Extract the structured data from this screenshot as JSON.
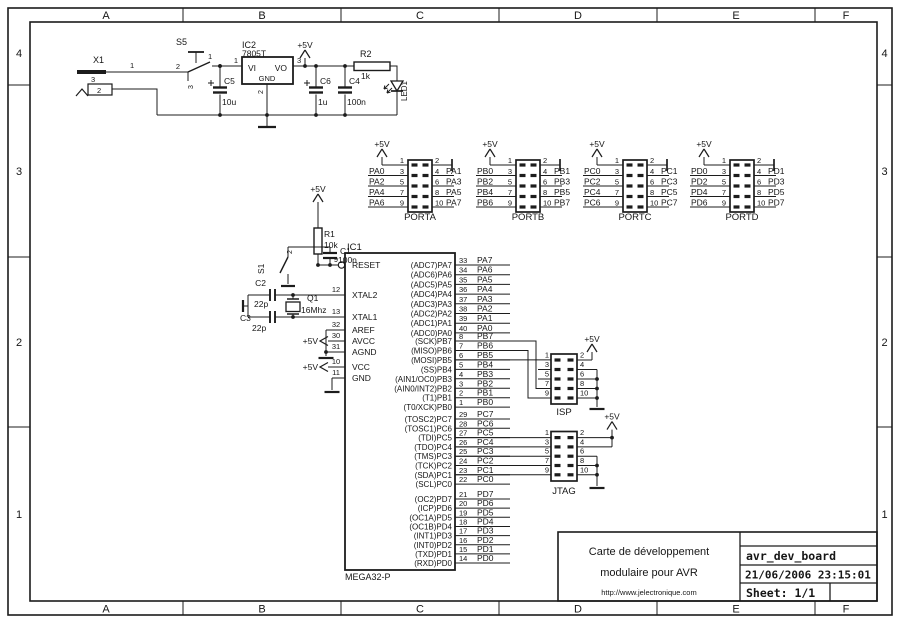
{
  "frame": {
    "columns": [
      "A",
      "B",
      "C",
      "D",
      "E",
      "F"
    ],
    "rows": [
      "4",
      "3",
      "2",
      "1"
    ]
  },
  "title_block": {
    "line1": "Carte de développement",
    "line2": "modulaire pour AVR",
    "url": "http://www.jelectronique.com",
    "doc": "avr_dev_board",
    "datetime": "21/06/2006 23:15:01",
    "sheet": "Sheet: 1/1"
  },
  "power": {
    "vcc": "+5V",
    "x1": {
      "ref": "X1",
      "pin1": "1",
      "pin2": "2",
      "pin3": "3"
    },
    "s5": {
      "ref": "S5",
      "pin1": "1",
      "pin2": "2",
      "pin3": "3"
    },
    "ic2": {
      "ref": "IC2",
      "value": "7805T",
      "vi": "VI",
      "vo": "VO",
      "gnd": "GND",
      "pin_in": "1",
      "pin_out": "3",
      "pin_gnd": "2"
    },
    "c5": {
      "ref": "C5",
      "value": "10u"
    },
    "c6": {
      "ref": "C6",
      "value": "1u"
    },
    "c4": {
      "ref": "C4",
      "value": "100n"
    },
    "r2": {
      "ref": "R2",
      "value": "1k"
    },
    "led": {
      "ref": "LED1"
    }
  },
  "reset": {
    "vcc": "+5V",
    "r1": {
      "ref": "R1",
      "value": "10k"
    },
    "c1": {
      "ref": "C1",
      "value": "100n"
    },
    "s1": {
      "ref": "S1",
      "pin_top": "2"
    }
  },
  "xtal": {
    "q1": {
      "ref": "Q1",
      "value": "16Mhz"
    },
    "c2": {
      "ref": "C2",
      "value": "22p"
    },
    "c3": {
      "ref": "C3",
      "value": "22p"
    }
  },
  "headers": [
    {
      "name": "PORTA",
      "vcc": "+5V",
      "left": [
        {
          "pin": "1",
          "net": ""
        },
        {
          "pin": "3",
          "net": "PA0"
        },
        {
          "pin": "5",
          "net": "PA2"
        },
        {
          "pin": "7",
          "net": "PA4"
        },
        {
          "pin": "9",
          "net": "PA6"
        }
      ],
      "right": [
        {
          "pin": "2",
          "net": ""
        },
        {
          "pin": "4",
          "net": "PA1"
        },
        {
          "pin": "6",
          "net": "PA3"
        },
        {
          "pin": "8",
          "net": "PA5"
        },
        {
          "pin": "10",
          "net": "PA7"
        }
      ]
    },
    {
      "name": "PORTB",
      "vcc": "+5V",
      "left": [
        {
          "pin": "1",
          "net": ""
        },
        {
          "pin": "3",
          "net": "PB0"
        },
        {
          "pin": "5",
          "net": "PB2"
        },
        {
          "pin": "7",
          "net": "PB4"
        },
        {
          "pin": "9",
          "net": "PB6"
        }
      ],
      "right": [
        {
          "pin": "2",
          "net": ""
        },
        {
          "pin": "4",
          "net": "PB1"
        },
        {
          "pin": "6",
          "net": "PB3"
        },
        {
          "pin": "8",
          "net": "PB5"
        },
        {
          "pin": "10",
          "net": "PB7"
        }
      ]
    },
    {
      "name": "PORTC",
      "vcc": "+5V",
      "left": [
        {
          "pin": "1",
          "net": ""
        },
        {
          "pin": "3",
          "net": "PC0"
        },
        {
          "pin": "5",
          "net": "PC2"
        },
        {
          "pin": "7",
          "net": "PC4"
        },
        {
          "pin": "9",
          "net": "PC6"
        }
      ],
      "right": [
        {
          "pin": "2",
          "net": ""
        },
        {
          "pin": "4",
          "net": "PC1"
        },
        {
          "pin": "6",
          "net": "PC3"
        },
        {
          "pin": "8",
          "net": "PC5"
        },
        {
          "pin": "10",
          "net": "PC7"
        }
      ]
    },
    {
      "name": "PORTD",
      "vcc": "+5V",
      "left": [
        {
          "pin": "1",
          "net": ""
        },
        {
          "pin": "3",
          "net": "PD0"
        },
        {
          "pin": "5",
          "net": "PD2"
        },
        {
          "pin": "7",
          "net": "PD4"
        },
        {
          "pin": "9",
          "net": "PD6"
        }
      ],
      "right": [
        {
          "pin": "2",
          "net": ""
        },
        {
          "pin": "4",
          "net": "PD1"
        },
        {
          "pin": "6",
          "net": "PD3"
        },
        {
          "pin": "8",
          "net": "PD5"
        },
        {
          "pin": "10",
          "net": "PD7"
        }
      ]
    }
  ],
  "mcu": {
    "ref": "IC1",
    "value": "MEGA32-P",
    "vcc": "+5V",
    "left_pins": [
      {
        "name": "RESET",
        "pin": "9"
      },
      {
        "name": "XTAL2",
        "pin": "12"
      },
      {
        "name": "XTAL1",
        "pin": "13"
      },
      {
        "name": "AREF",
        "pin": "32"
      },
      {
        "name": "AVCC",
        "pin": "30"
      },
      {
        "name": "AGND",
        "pin": "31"
      },
      {
        "name": "VCC",
        "pin": "10"
      },
      {
        "name": "GND",
        "pin": "11"
      }
    ],
    "pa": [
      {
        "name": "(ADC7)PA7",
        "pin": "33",
        "net": "PA7"
      },
      {
        "name": "(ADC6)PA6",
        "pin": "34",
        "net": "PA6"
      },
      {
        "name": "(ADC5)PA5",
        "pin": "35",
        "net": "PA5"
      },
      {
        "name": "(ADC4)PA4",
        "pin": "36",
        "net": "PA4"
      },
      {
        "name": "(ADC3)PA3",
        "pin": "37",
        "net": "PA3"
      },
      {
        "name": "(ADC2)PA2",
        "pin": "38",
        "net": "PA2"
      },
      {
        "name": "(ADC1)PA1",
        "pin": "39",
        "net": "PA1"
      },
      {
        "name": "(ADC0)PA0",
        "pin": "40",
        "net": "PA0"
      }
    ],
    "pb": [
      {
        "name": "(SCK)PB7",
        "pin": "8",
        "net": "PB7"
      },
      {
        "name": "(MISO)PB6",
        "pin": "7",
        "net": "PB6"
      },
      {
        "name": "(MOSI)PB5",
        "pin": "6",
        "net": "PB5"
      },
      {
        "name": "(SS)PB4",
        "pin": "5",
        "net": "PB4"
      },
      {
        "name": "(AIN1/OC0)PB3",
        "pin": "4",
        "net": "PB3"
      },
      {
        "name": "(AIN0/INT2)PB2",
        "pin": "3",
        "net": "PB2"
      },
      {
        "name": "(T1)PB1",
        "pin": "2",
        "net": "PB1"
      },
      {
        "name": "(T0/XCK)PB0",
        "pin": "1",
        "net": "PB0"
      }
    ],
    "pc": [
      {
        "name": "(TOSC2)PC7",
        "pin": "29",
        "net": "PC7"
      },
      {
        "name": "(TOSC1)PC6",
        "pin": "28",
        "net": "PC6"
      },
      {
        "name": "(TDI)PC5",
        "pin": "27",
        "net": "PC5"
      },
      {
        "name": "(TDO)PC4",
        "pin": "26",
        "net": "PC4"
      },
      {
        "name": "(TMS)PC3",
        "pin": "25",
        "net": "PC3"
      },
      {
        "name": "(TCK)PC2",
        "pin": "24",
        "net": "PC2"
      },
      {
        "name": "(SDA)PC1",
        "pin": "23",
        "net": "PC1"
      },
      {
        "name": "(SCL)PC0",
        "pin": "22",
        "net": "PC0"
      }
    ],
    "pd": [
      {
        "name": "(OC2)PD7",
        "pin": "21",
        "net": "PD7"
      },
      {
        "name": "(ICP)PD6",
        "pin": "20",
        "net": "PD6"
      },
      {
        "name": "(OC1A)PD5",
        "pin": "19",
        "net": "PD5"
      },
      {
        "name": "(OC1B)PD4",
        "pin": "18",
        "net": "PD4"
      },
      {
        "name": "(INT1)PD3",
        "pin": "17",
        "net": "PD3"
      },
      {
        "name": "(INT0)PD2",
        "pin": "16",
        "net": "PD2"
      },
      {
        "name": "(TXD)PD1",
        "pin": "15",
        "net": "PD1"
      },
      {
        "name": "(RXD)PD0",
        "pin": "14",
        "net": "PD0"
      }
    ]
  },
  "isp": {
    "name": "ISP",
    "vcc": "+5V",
    "left_pins": [
      "1",
      "3",
      "5",
      "7",
      "9"
    ],
    "right_pins": [
      "2",
      "4",
      "6",
      "8",
      "10"
    ]
  },
  "jtag": {
    "name": "JTAG",
    "vcc": "+5V",
    "left_pins": [
      "1",
      "3",
      "5",
      "7",
      "9"
    ],
    "right_pins": [
      "2",
      "4",
      "6",
      "8",
      "10"
    ]
  }
}
